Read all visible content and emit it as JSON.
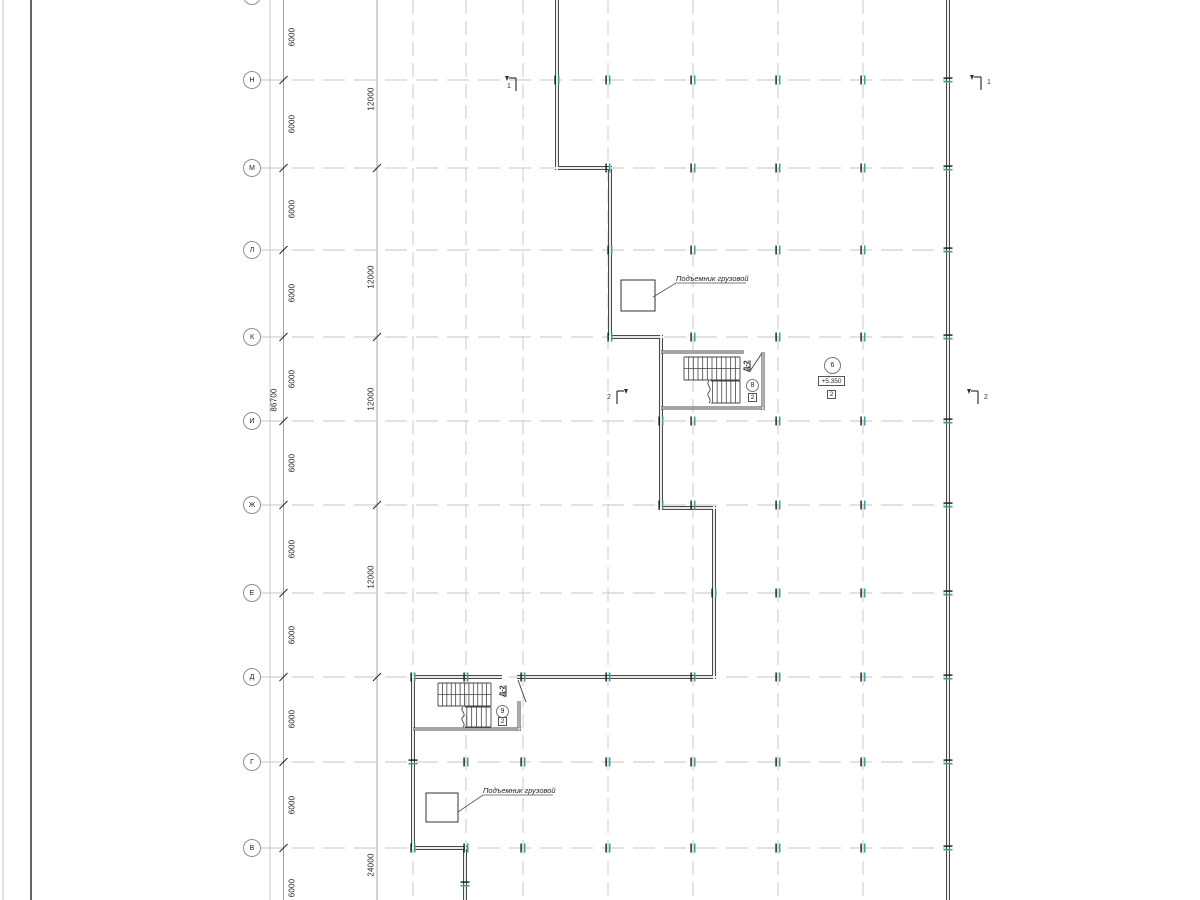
{
  "axes": {
    "row_labels": [
      "Н",
      "М",
      "Л",
      "К",
      "И",
      "Ж",
      "Е",
      "Д",
      "Г",
      "В"
    ]
  },
  "dimensions": {
    "bays_6000": [
      "6000",
      "6000",
      "6000",
      "6000",
      "6000",
      "6000",
      "6000",
      "6000",
      "6000",
      "6000",
      "6000"
    ],
    "bays_12000": [
      "12000",
      "12000",
      "12000",
      "12000"
    ],
    "bay_24000": "24000",
    "total": "86700"
  },
  "annotations": {
    "hoist_upper_label": "Подъемник грузовой",
    "hoist_lower_label": "Подъемник грузовой"
  },
  "stairs": {
    "upper": {
      "name": "Д-2",
      "node": "8",
      "box": "2"
    },
    "lower": {
      "name": "Д-2",
      "node": "9",
      "box": "2"
    }
  },
  "room_tags": {
    "node": "6",
    "elevation": "+5.350",
    "box": "2"
  },
  "sections": {
    "s1": "1",
    "s2": "2"
  },
  "colors": {
    "grid": "#c6c6c6",
    "wall": "#4a4a4a",
    "column": "#3fa0a0",
    "dim_line": "#8c8c8c",
    "text": "#1f1f1f"
  }
}
